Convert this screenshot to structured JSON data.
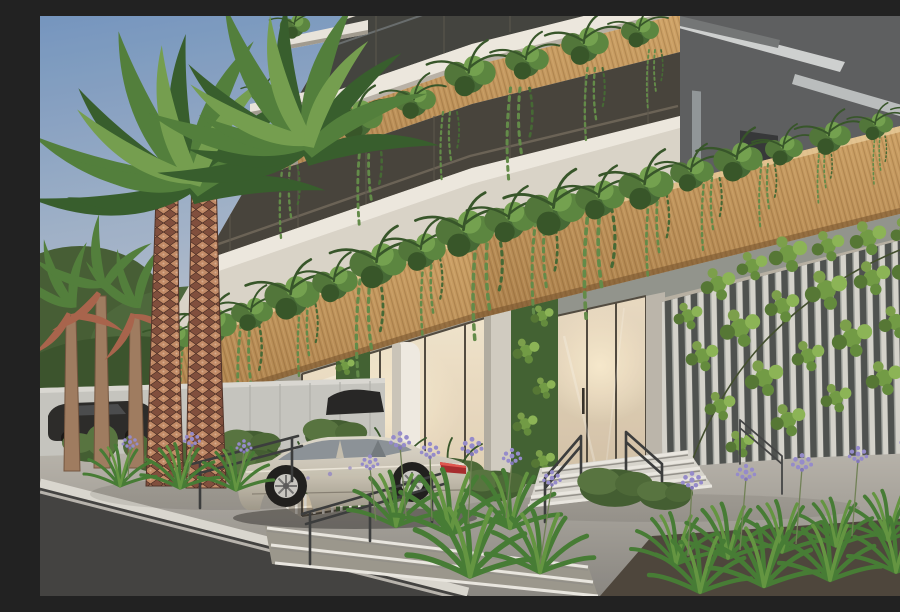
{
  "image": {
    "type": "architectural-render",
    "subject": "Street-level entrance of a modern residential tower with planted balconies",
    "mood": "dusk light, warm glowing lobby",
    "visible_text": []
  },
  "palette": {
    "sky_top": "#6f94c3",
    "sky_horizon": "#ccd0d7",
    "facade_white": "#dedbd3",
    "slab_white": "#eceae4",
    "window_dark": "#3b3f3e",
    "neighbor_gray": "#575b60",
    "wood_light": "#cfa469",
    "wood_dark": "#a87e4b",
    "teal_glass": "#7db6bc",
    "soffit_gray": "#8e938f",
    "slat_dark": "#474d4f",
    "slat_light": "#d3d4d0",
    "greenwall": "#3a5e31",
    "leaf_main": "#4e7a3c",
    "door_glass": "#cfc0a8",
    "pavement_light": "#b7b5b0",
    "pavement_dark": "#858583",
    "asphalt": "#3c3e40",
    "curb_white": "#d9d8d4",
    "car_silver_light": "#dcd9d0",
    "car_silver_dark": "#9b978c",
    "agapanthus_purple": "#918ad0",
    "trunk_base": "#7c4a3c",
    "trunk_diamond": "#c08968"
  },
  "scene": {
    "background": [
      "soft blue dusk sky",
      "dark gray neighboring building with pale slab edges",
      "tree line and light boundary wall with parked dark cars"
    ],
    "building": [
      "white balcony slabs with tinted glazing",
      "timber planter fascia with cascading ferns and trailing succulents",
      "turquoise glass accent panel",
      "vertical white slat screen covered in climbing ivy",
      "living green-wall columns",
      "warm lit double-height glass lobby and entry door"
    ],
    "foreground": [
      "two tall palms with diamond-patterned trunks",
      "smaller palms with russet fronds",
      "silver sedan parked at the drop-off",
      "entrance stair with slim steel handrails",
      "plaza ramp, wide steps and pale curb to the street",
      "agapanthus beds with purple blooms"
    ]
  }
}
